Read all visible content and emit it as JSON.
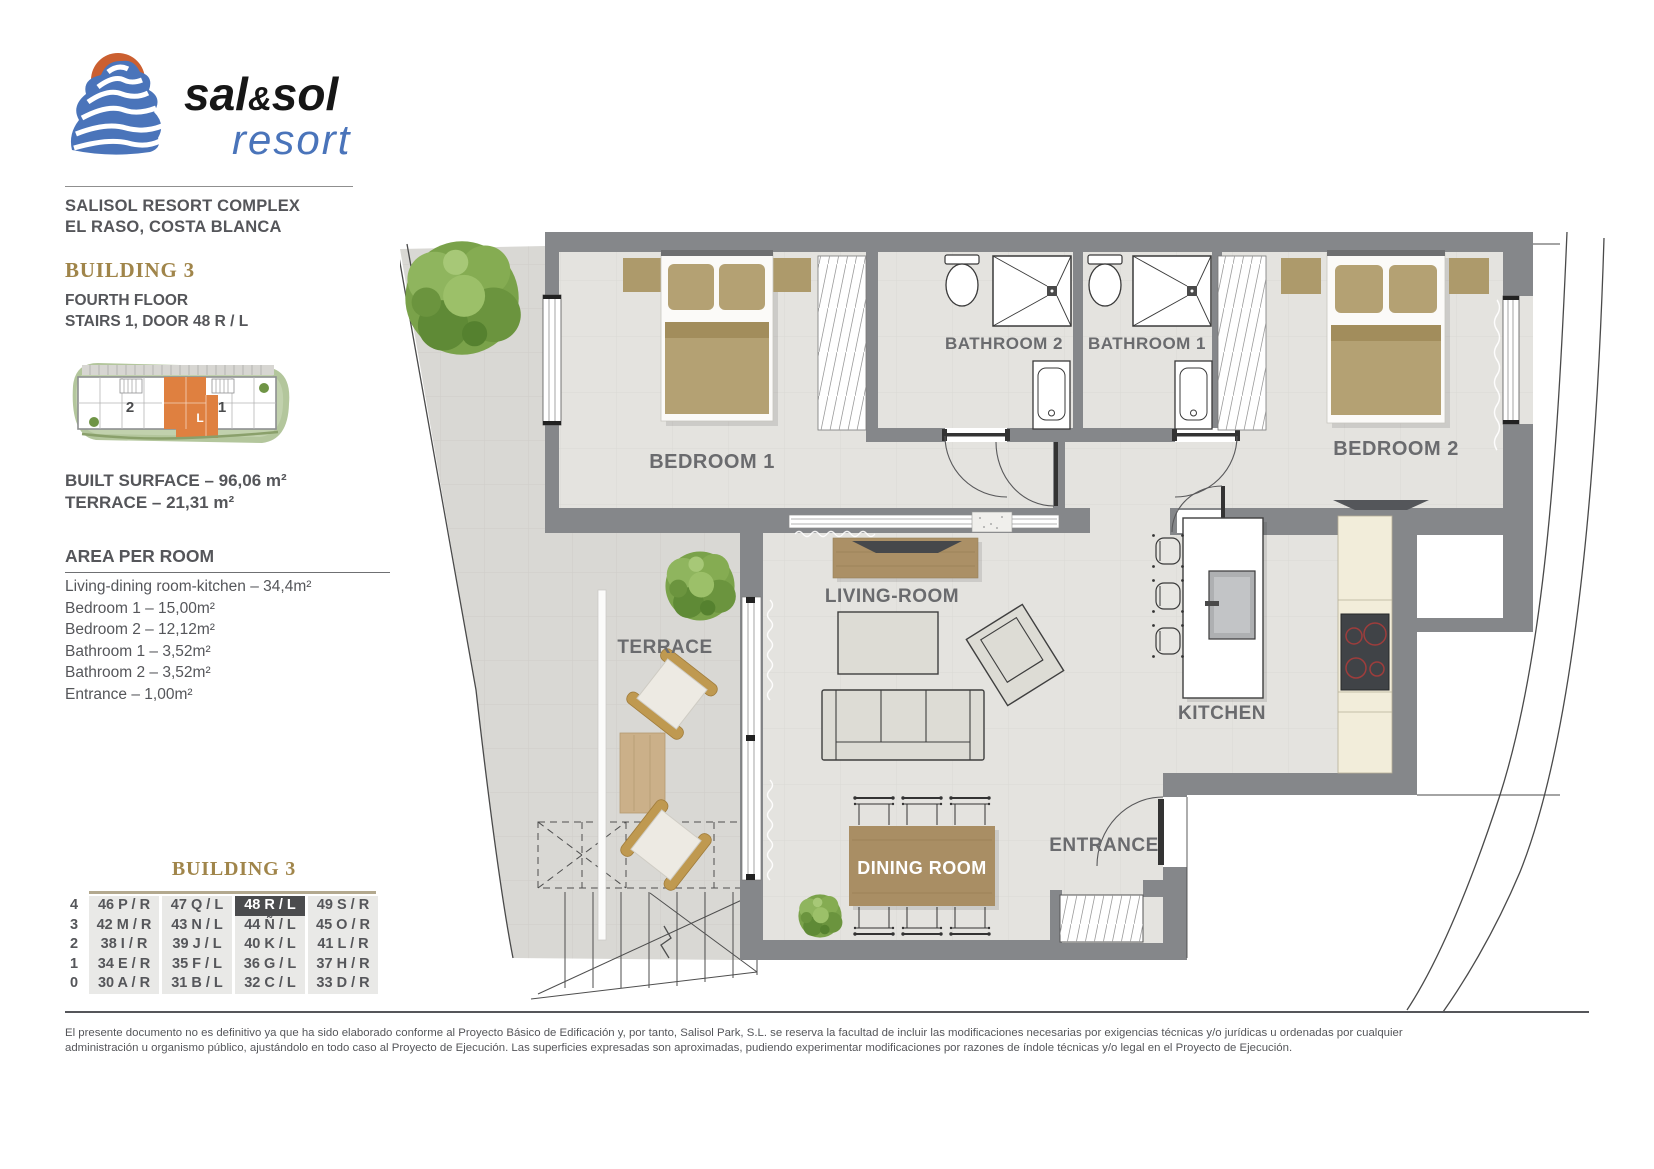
{
  "logo": {
    "part1": "sal",
    "amp": "&",
    "part2": "sol",
    "subtitle": "resort",
    "sun_color": "#cb5f30",
    "wave_color": "#4a74ba"
  },
  "header": {
    "line1": "SALISOL RESORT COMPLEX",
    "line2": "EL RASO, COSTA BLANCA"
  },
  "building": {
    "title": "BUILDING 3",
    "floor": "FOURTH FLOOR",
    "door": "STAIRS 1, DOOR 48 R / L"
  },
  "minimap": {
    "stair_left": "2",
    "stair_right": "1",
    "unit": "L",
    "highlight_color": "#df8040"
  },
  "surface": {
    "built": "BUILT SURFACE  – 96,06 m²",
    "terrace": "TERRACE – 21,31 m²"
  },
  "area_per_room": {
    "title": "AREA PER ROOM",
    "items": [
      "Living-dining room-kitchen – 34,4m²",
      "Bedroom 1 – 15,00m²",
      "Bedroom 2 – 12,12m²",
      "Bathroom 1 – 3,52m²",
      "Bathroom 2 – 3,52m²",
      "Entrance – 1,00m²"
    ]
  },
  "floorplan": {
    "labels": {
      "bedroom1": "BEDROOM 1",
      "bathroom2": "BATHROOM 2",
      "bathroom1": "BATHROOM 1",
      "bedroom2": "BEDROOM 2",
      "living": "LIVING-ROOM",
      "terrace": "TERRACE",
      "kitchen": "KITCHEN",
      "entrance": "ENTRANCE",
      "dining": "DINING ROOM"
    },
    "wall_color": "#85878a",
    "floor_color": "#e4e3df",
    "paving_color": "#d9d8d4"
  },
  "units_table": {
    "title": "BUILDING 3",
    "highlight": {
      "row": 0,
      "col": 2
    },
    "rows": [
      {
        "floor": "4",
        "cells": [
          "46 P / R",
          "47 Q / L",
          "48 R / L",
          "49 S / R"
        ]
      },
      {
        "floor": "3",
        "cells": [
          "42 M / R",
          "43 N / L",
          "44 Ñ / L",
          "45 O / R"
        ]
      },
      {
        "floor": "2",
        "cells": [
          "38 I / R",
          "39 J / L",
          "40 K / L",
          "41 L / R"
        ]
      },
      {
        "floor": "1",
        "cells": [
          "34 E / R",
          "35 F / L",
          "36 G / L",
          "37 H / R"
        ]
      },
      {
        "floor": "0",
        "cells": [
          "30 A / R",
          "31 B / L",
          "32 C / L",
          "33 D / R"
        ]
      }
    ]
  },
  "disclaimer": {
    "line1": "El presente documento no es definitivo ya que ha sido elaborado conforme al Proyecto Básico de Edificación y, por tanto, Salisol Park, S.L. se reserva la facultad de incluir las modificaciones necesarias por exigencias técnicas y/o jurídicas u ordenadas por cualquier",
    "line2": "administración u organismo público, ajustándolo en todo caso al Proyecto de Ejecución. Las superficies expresadas son aproximadas, pudiendo experimentar modificaciones por razones de índole técnicas y/o legal en el Proyecto de Ejecución."
  }
}
